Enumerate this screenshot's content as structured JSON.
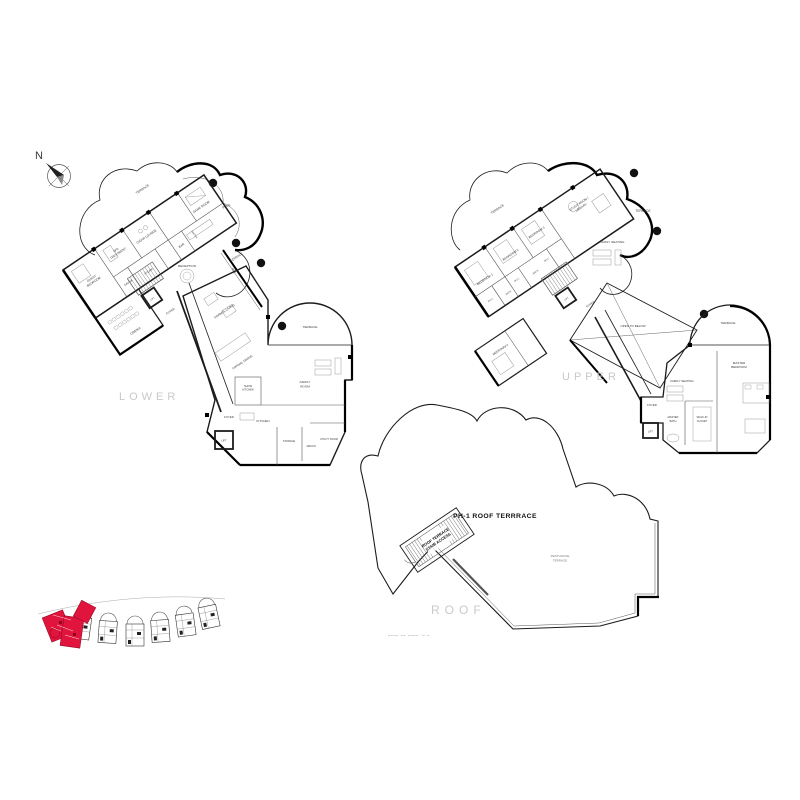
{
  "compass": {
    "label": "N"
  },
  "levels": {
    "lower": "LOWER",
    "upper": "UPPER",
    "roof": "ROOF"
  },
  "colors": {
    "highlight_red": "#e0143c",
    "wall": "#1c1c1c",
    "light_label": "#c9c9c9"
  },
  "lower_plan": {
    "terrace_top": "TERRACE",
    "pool": "POOL",
    "bbq": "BBQ",
    "terrace_right": "TERRACE",
    "game_room": "GAME ROOM",
    "cigar_lounge": "CIGAR LOUNGE",
    "bar": "BAR",
    "pantry": "PANTRY",
    "spa_1": "SPA",
    "spa_2": "TREATMENT",
    "sauna": "SAUNA",
    "steam": "STEAM",
    "guest_1": "GUEST",
    "guest_2": "BEDROOM",
    "cinema": "CINEMA",
    "reception": "RECEPTION",
    "foyer_a": "FOYER",
    "lift_a": "LIFT",
    "formal_living": "FORMAL LIVING",
    "formal_dining": "FORMAL DINING",
    "show_kitchen_1": "SHOW",
    "show_kitchen_2": "KITCHEN",
    "terrace_arc": "TERRACE",
    "family_1": "FAMILY",
    "family_2": "ROOM",
    "foyer_b": "FOYER",
    "lift_b": "LIFT",
    "kitchen": "KITCHEN",
    "storage": "STORAGE",
    "aircon": "AIRCON",
    "utility": "UTILITY ROOM"
  },
  "upper_plan": {
    "terrace_left": "TERRACE",
    "terrace_right": "TERRACE",
    "terrace_arc": "TERRACE",
    "bedroom1": "BEDROOM 1",
    "bedroom2": "BEDROOM 2",
    "bedroom3": "BEDROOM 3",
    "bedroom4": "BEDROOM 4",
    "study_1": "STUDY ROOM /",
    "study_2": "LIBRARY",
    "family_seating_a": "FAMILY SEATING",
    "family_seating_b": "FAMILY SEATING",
    "wic_1": "W.I.C",
    "wic_2": "W.I.C",
    "wic_3": "W.I.C",
    "bath_1": "BATH",
    "bath_2": "BATH",
    "foyer_a": "FOYER",
    "lift_a": "LIFT",
    "open_to_below": "OPEN TO BELOW",
    "master_bed_1": "MASTER",
    "master_bed_2": "BEDROOM",
    "foyer_b": "FOYER",
    "lift_b": "LIFT",
    "master_bath_1": "MASTER",
    "master_bath_2": "BATH",
    "closet_1": "WALK-IN",
    "closet_2": "CLOSET"
  },
  "roof_plan": {
    "title": "PH-1 ROOF TERRRACE",
    "stair_1": "ROOF TERRACE",
    "stair_2": "STAIR ACCESS",
    "penthouse_1": "PENTHOUSE",
    "penthouse_2": "TERRACE",
    "micro_note": "–––– –– ––––   ·–  –"
  }
}
